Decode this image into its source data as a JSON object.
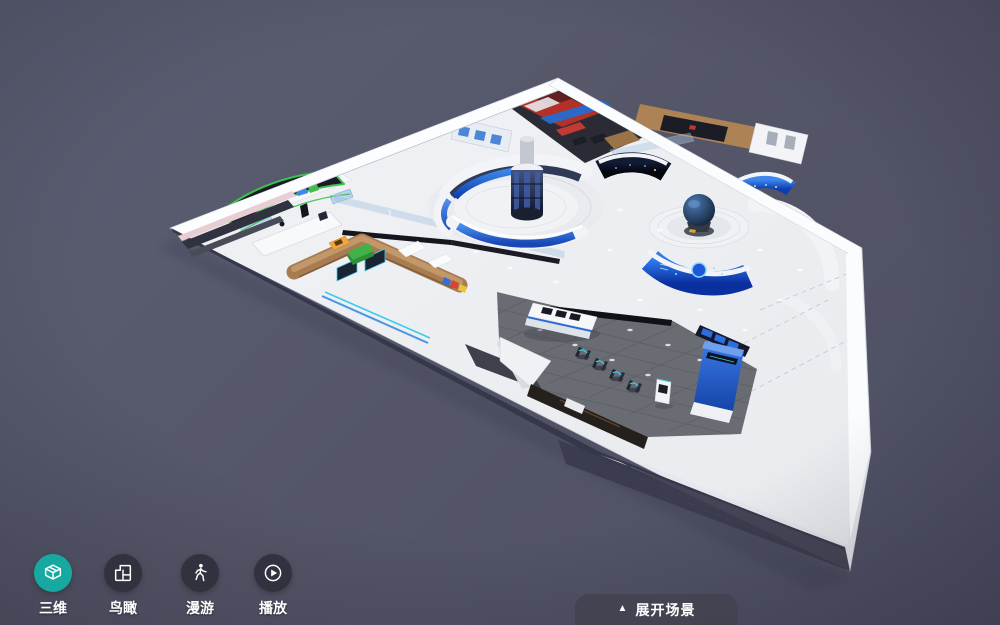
{
  "scene": {
    "name": "exhibition-hall-3d-dollhouse",
    "background_color": "#555769",
    "palette": {
      "active_teal": "#17a9a1",
      "inactive_button": "#32343f",
      "screen_blue": "#1f5ed8",
      "led_green": "#3cc14d",
      "wood_brown": "#a87c50",
      "lobby_floor": "#6a6c73",
      "expand_button_bg": "#464753"
    }
  },
  "toolbar": {
    "items": [
      {
        "id": "3d",
        "label": "三维",
        "icon": "cube-3d-icon",
        "active": true
      },
      {
        "id": "birdseye",
        "label": "鸟瞰",
        "icon": "floorplan-icon",
        "active": false
      },
      {
        "id": "roam",
        "label": "漫游",
        "icon": "walking-person-icon",
        "active": false
      },
      {
        "id": "play",
        "label": "播放",
        "icon": "play-circle-icon",
        "active": false
      }
    ]
  },
  "expand_button": {
    "icon_glyph": "▲",
    "label": "展开场景"
  }
}
